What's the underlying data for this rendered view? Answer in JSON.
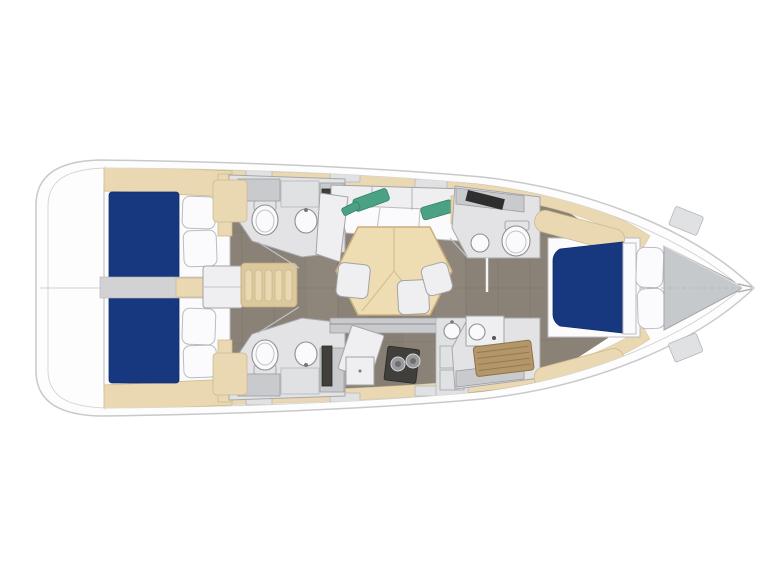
{
  "scene": {
    "name": "sailing-yacht-interior-floorplan-top-view",
    "orientation": "bow-right-stern-left"
  },
  "palette": {
    "background": "#ffffff",
    "hull_fill": "#fdfdfd",
    "hull_stroke": "#c9c9cc",
    "deck_tan": "#e9d8b2",
    "deck_tan_dark": "#dcc89d",
    "floor": "#8a8277",
    "floor_seam": "#78705f",
    "floor_light": "#979083",
    "bed_blue": "#17387f",
    "accent_green": "#4aa183",
    "teak": "#b3966a",
    "stove_dark": "#413f3c"
  },
  "areas": {
    "stern_platform": "stern-swim-platform",
    "aft_cabin_port": "aft-cabin-port-double-berth",
    "aft_cabin_starboard": "aft-cabin-starboard-double-berth",
    "aft_head_port": "aft-head-port-toilet-sink",
    "aft_head_starboard": "aft-head-starboard-toilet-sink",
    "companionway": "companionway-steps",
    "engine_box": "engine-compartment-box",
    "salon": "salon-hex-table-sofa-stools",
    "galley": "galley-two-burner-stove-sink",
    "forward_head": "forward-head-toilet-sink",
    "forward_shower": "forward-shower-teak-grate",
    "forward_cabin": "forward-cabin-double-berth",
    "bow_locker": "bow-anchor-locker"
  }
}
